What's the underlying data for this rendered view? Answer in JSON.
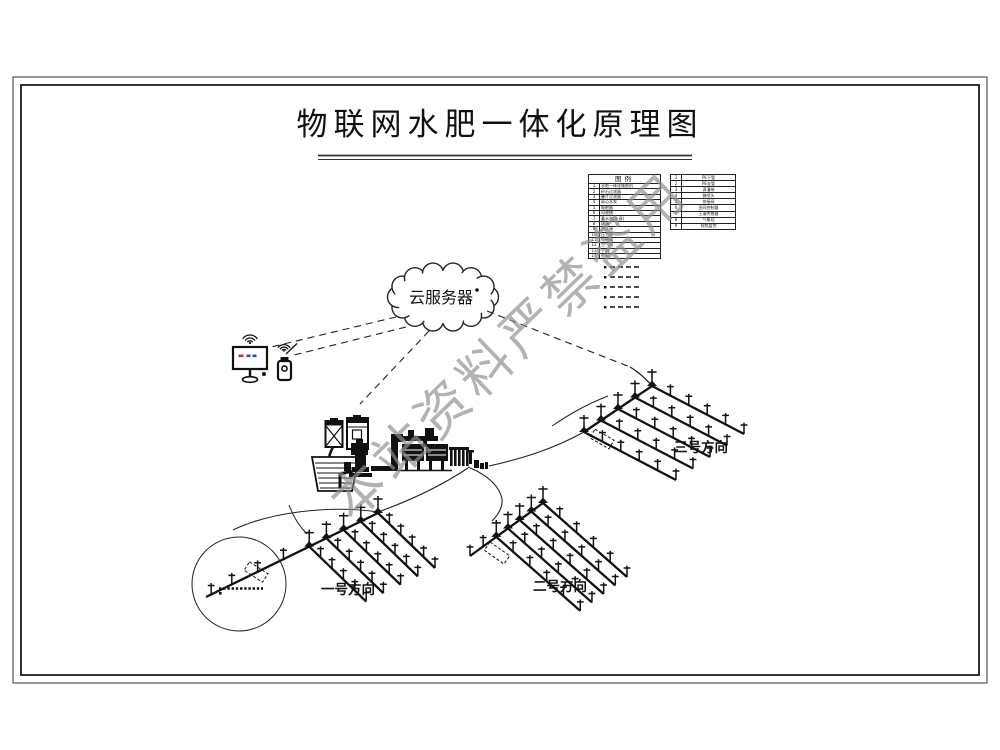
{
  "page": {
    "title": "物联网水肥一体化原理图"
  },
  "watermark": {
    "text": "本站资料严禁盗用",
    "color": "#8f8f8f"
  },
  "cloud": {
    "label": "云服务器",
    "icon": "cloud-icon"
  },
  "devices": {
    "monitor_icon": "computer-monitor-icon",
    "phone_icon": "smartphone-icon",
    "wifi_icon": "wifi-signal-icon"
  },
  "legend": {
    "main_table": {
      "header": "图例",
      "rows": [
        {
          "num": "1",
          "label": "水肥一体化施肥机"
        },
        {
          "num": "2",
          "label": "砂石过滤器"
        },
        {
          "num": "3",
          "label": "叠片过滤器"
        },
        {
          "num": "4",
          "label": "离心水泵"
        },
        {
          "num": "5",
          "label": "吸肥器"
        },
        {
          "num": "6",
          "label": "母液桶"
        },
        {
          "num": "7",
          "label": "蓄水池(水源)"
        },
        {
          "num": "8",
          "label": "球阀"
        },
        {
          "num": "9",
          "label": "逆止阀"
        },
        {
          "num": "10",
          "label": "压力表"
        },
        {
          "num": "11",
          "label": "电磁阀"
        },
        {
          "num": "12",
          "label": "空气阀"
        },
        {
          "num": "13",
          "label": "手机"
        },
        {
          "num": "14",
          "label": "电脑"
        }
      ]
    },
    "side_table": {
      "rows": [
        {
          "num": "1",
          "label": "PE干管"
        },
        {
          "num": "2",
          "label": "PE支管"
        },
        {
          "num": "3",
          "label": "滴灌带"
        },
        {
          "num": "4",
          "label": "微喷头"
        },
        {
          "num": "5",
          "label": "快接阀"
        },
        {
          "num": "6",
          "label": "田间控制器"
        },
        {
          "num": "7",
          "label": "土壤传感器"
        },
        {
          "num": "8",
          "label": "气象站"
        },
        {
          "num": "9",
          "label": "视频监控"
        }
      ]
    }
  },
  "fields": [
    {
      "label": "一号方向"
    },
    {
      "label": "二号方向"
    },
    {
      "label": "三号方向"
    }
  ],
  "colors": {
    "line": "#1c1c1c",
    "watermark": "#8f8f8f",
    "screen_red": "#c03a2b",
    "screen_blue": "#2e4bc6"
  }
}
